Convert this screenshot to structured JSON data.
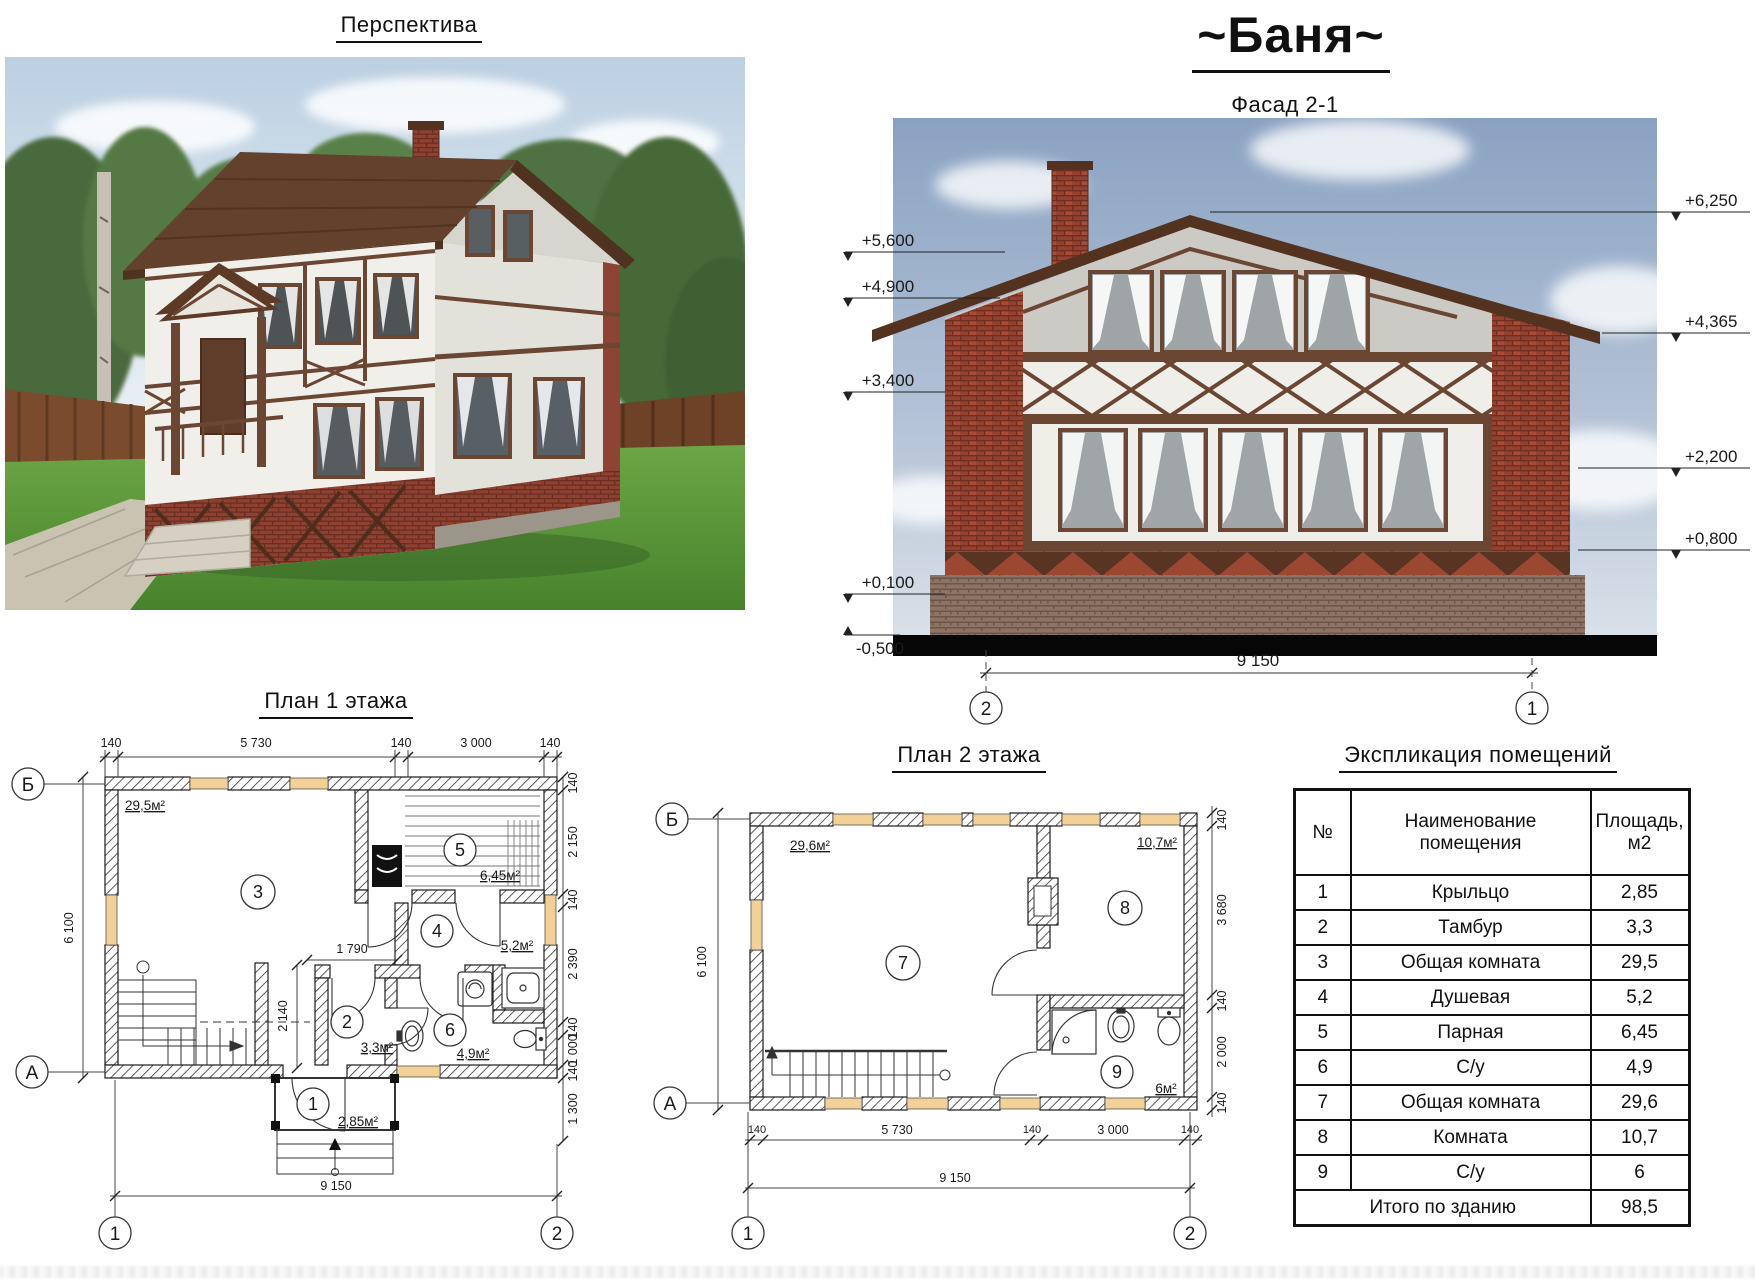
{
  "titles": {
    "perspective": "Перспектива",
    "main": "~Баня~",
    "facade": "Фасад 2-1",
    "plan1": "План 1 этажа",
    "plan2": "План 2 этажа",
    "explication": "Экспликация помещений"
  },
  "facade": {
    "marks_left": [
      "+5,600",
      "+4,900",
      "+3,400",
      "+0,100",
      "-0,500"
    ],
    "marks_right": [
      "+6,250",
      "+4,365",
      "+2,200",
      "+0,800"
    ],
    "dim_width": "9 150",
    "axis_left": "2",
    "axis_right": "1"
  },
  "plan1": {
    "dims_top": [
      "140",
      "5 730",
      "140",
      "3 000",
      "140"
    ],
    "dims_right": [
      "140",
      "2 150",
      "140",
      "2 390",
      "140",
      "1 000",
      "140",
      "1 300"
    ],
    "dim_left": "6 100",
    "dim_bottom": "9 150",
    "dim_inner_width": "1 790",
    "dim_inner_height": "2 140",
    "axis_top": "Б",
    "axis_bottom": "А",
    "axis_col_left": "1",
    "axis_col_right": "2",
    "rooms": [
      {
        "num": "3",
        "area": "29,5м²"
      },
      {
        "num": "5",
        "area": "6,45м²"
      },
      {
        "num": "4",
        "area": "5,2м²"
      },
      {
        "num": "2",
        "area": "3,3м²"
      },
      {
        "num": "6",
        "area": "4,9м²"
      },
      {
        "num": "1",
        "area": "2,85м²"
      }
    ]
  },
  "plan2": {
    "dims_bottom": [
      "140",
      "5 730",
      "140",
      "3 000",
      "140"
    ],
    "dims_right": [
      "140",
      "3 680",
      "140",
      "2 000",
      "140"
    ],
    "dim_left": "6 100",
    "dim_total": "9 150",
    "axis_top": "Б",
    "axis_bottom": "А",
    "axis_col_left": "1",
    "axis_col_right": "2",
    "rooms": [
      {
        "num": "7",
        "area": "29,6м²"
      },
      {
        "num": "8",
        "area": "10,7м²"
      },
      {
        "num": "9",
        "area": "6м²"
      }
    ]
  },
  "explication": {
    "col_num": "№",
    "col_name": "Наименование помещения",
    "col_area": "Площадь,\nм2",
    "rows": [
      {
        "num": "1",
        "name": "Крыльцо",
        "area": "2,85"
      },
      {
        "num": "2",
        "name": "Тамбур",
        "area": "3,3"
      },
      {
        "num": "3",
        "name": "Общая комната",
        "area": "29,5"
      },
      {
        "num": "4",
        "name": "Душевая",
        "area": "5,2"
      },
      {
        "num": "5",
        "name": "Парная",
        "area": "6,45"
      },
      {
        "num": "6",
        "name": "С/у",
        "area": "4,9"
      },
      {
        "num": "7",
        "name": "Общая комната",
        "area": "29,6"
      },
      {
        "num": "8",
        "name": "Комната",
        "area": "10,7"
      },
      {
        "num": "9",
        "name": "С/у",
        "area": "6"
      }
    ],
    "total_label": "Итого по зданию",
    "total_value": "98,5"
  }
}
